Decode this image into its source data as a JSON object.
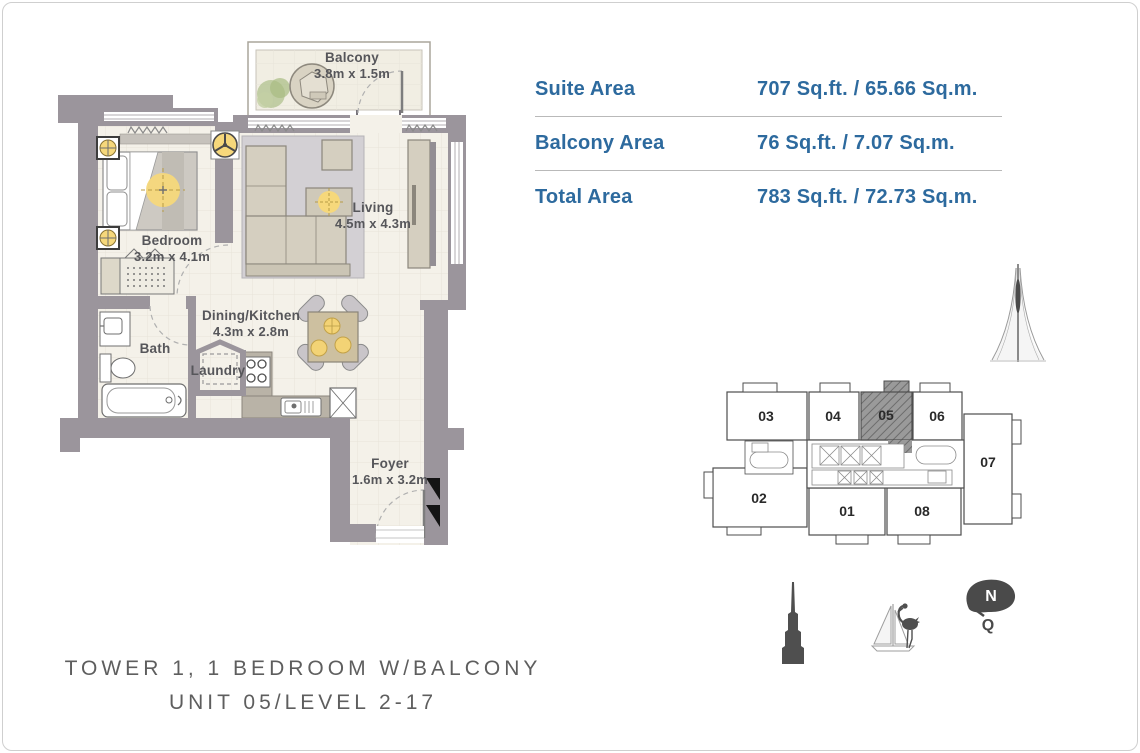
{
  "page": {
    "background": "#ffffff",
    "border_color": "#cfcfcf"
  },
  "area_table": {
    "text_color": "#2d6a9e",
    "rows": [
      {
        "label": "Suite Area",
        "value": "707 Sq.ft. / 65.66 Sq.m."
      },
      {
        "label": "Balcony Area",
        "value": "76 Sq.ft. / 7.07 Sq.m."
      },
      {
        "label": "Total Area",
        "value": "783 Sq.ft. / 72.73 Sq.m."
      }
    ]
  },
  "floor_plan": {
    "wall_color": "#9b959c",
    "floor_color": "#f4f1e9",
    "accent_light_color": "#f6d87b",
    "rooms": [
      {
        "name": "Balcony",
        "dims": "3.8m x 1.5m"
      },
      {
        "name": "Bedroom",
        "dims": "3.2m x 4.1m"
      },
      {
        "name": "Living",
        "dims": "4.5m x 4.3m"
      },
      {
        "name": "Dining/Kitchen",
        "dims": "4.3m x 2.8m"
      },
      {
        "name": "Bath",
        "dims": ""
      },
      {
        "name": "Laundry",
        "dims": ""
      },
      {
        "name": "Foyer",
        "dims": "1.6m x 3.2m"
      }
    ]
  },
  "key_plan": {
    "units": [
      "03",
      "04",
      "05",
      "06",
      "07",
      "02",
      "01",
      "08"
    ],
    "highlighted_unit": "05"
  },
  "compass": {
    "north_label": "N",
    "tail_label": "Q"
  },
  "icons": [
    "creek-tower-icon",
    "burj-khalifa-icon",
    "sailboat-flamingo-icon",
    "compass-north-icon"
  ],
  "footer": {
    "line1": "TOWER 1, 1 BEDROOM W/BALCONY",
    "line2": "UNIT 05/LEVEL 2-17"
  }
}
